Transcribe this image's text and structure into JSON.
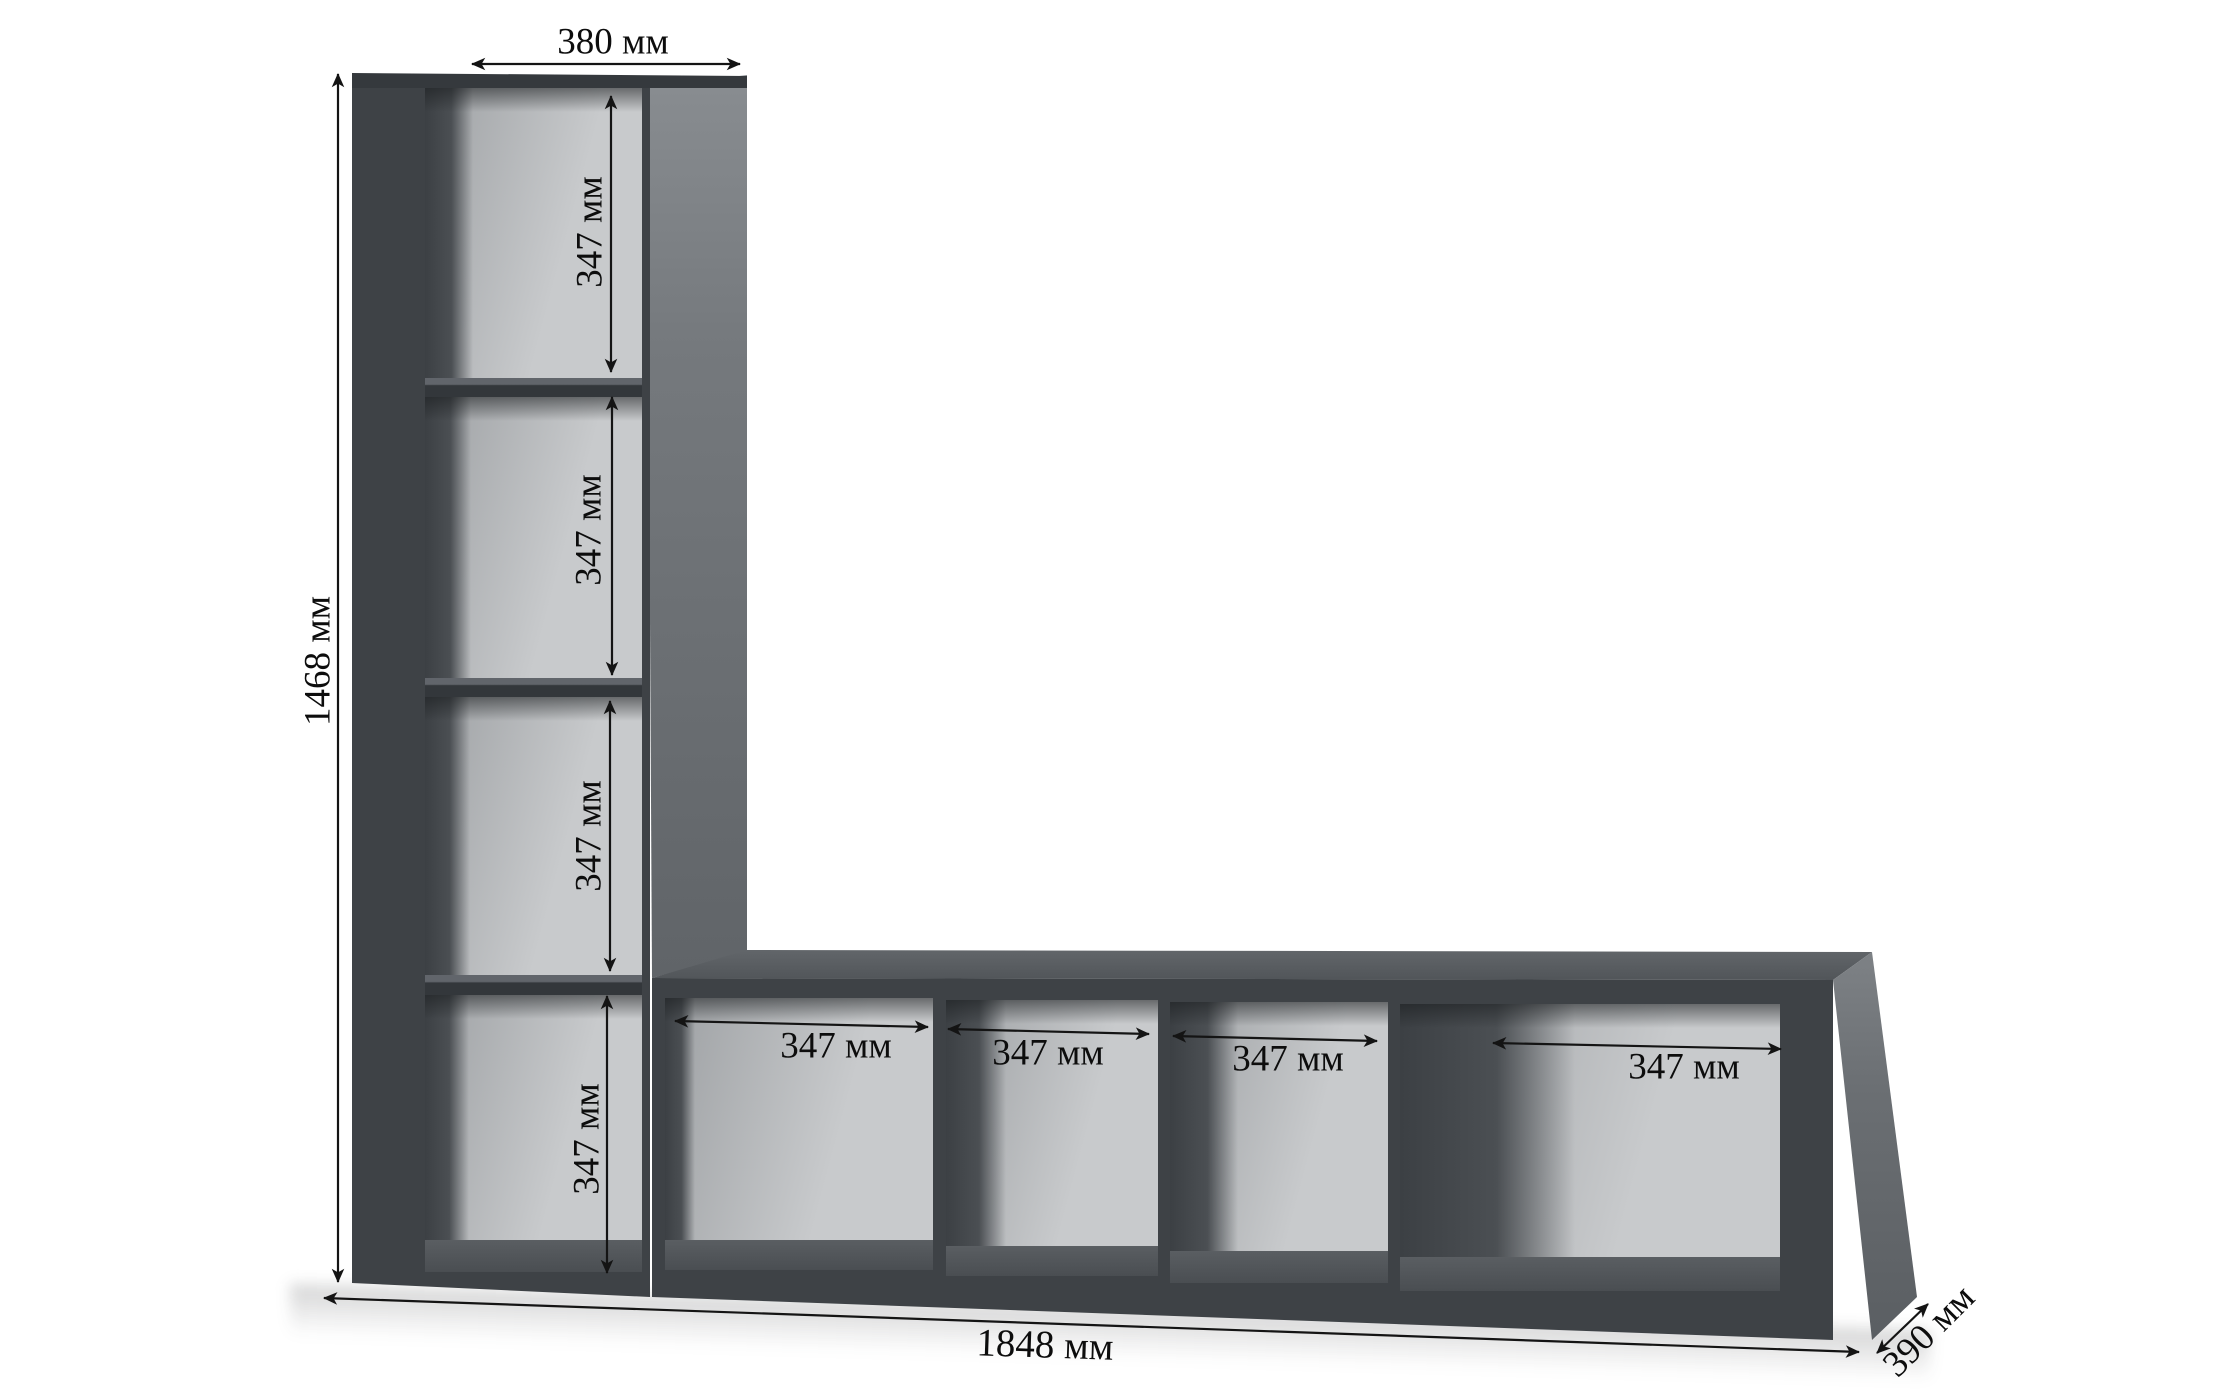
{
  "diagram": {
    "type": "furniture-dimension-diagram",
    "unit_labels": {
      "top_width": "380 мм",
      "total_height": "1468 мм",
      "total_width": "1848 мм",
      "depth": "390 мм"
    },
    "tall_cell_heights": [
      "347 мм",
      "347 мм",
      "347 мм",
      "347 мм"
    ],
    "bottom_cell_widths": [
      "347 мм",
      "347 мм",
      "347 мм",
      "347 мм"
    ]
  },
  "colors": {
    "bg": "#ffffff",
    "frame": "#3e4246",
    "frame-edge": "#35393d",
    "shelf-face": "#33373b",
    "shelf-top": "#61656b",
    "back-light": "#c8cacc",
    "back-mid": "#9da0a3",
    "wall-shadow": "#42464a",
    "side-top": "#898d91",
    "side-bottom": "#606468",
    "topface-light": "#63676b",
    "topface-dark": "#505458",
    "floor-inside": "#4d5155",
    "line": "#141414",
    "text": "#0d0d0d"
  }
}
